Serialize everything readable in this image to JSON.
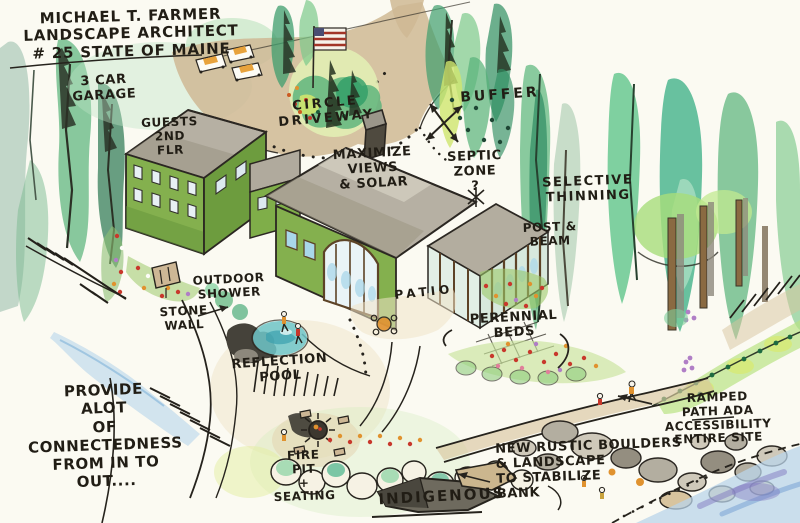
{
  "title_block": {
    "text": "MICHAEL T. FARMER\nLANDSCAPE ARCHITECT\n# 25 STATE OF MAINE"
  },
  "labels": {
    "garage": "3 CAR\nGARAGE",
    "guest_quarters": "GUESTS\n2ND\nFLR",
    "circle_driveway": "CIRCLE\nDRIVEWAY",
    "buffer": "BUFFER",
    "maximize_views_solar": "MAXIMIZE\nVIEWS\n& SOLAR",
    "septic_zone": "SEPTIC\nZONE\n?",
    "selective_thinning": "SELECTIVE\nTHINNING",
    "post_and_beam": "POST &\nBEAM",
    "outdoor_shower": "OUTDOOR\nSHOWER",
    "stone_wall": "STONE\nWALL",
    "patio": "PATIO",
    "perennial_beds": "PERENNIAL\nBEDS",
    "reflection_pool": "REFLECTION\nPOOL",
    "connectedness_note": "PROVIDE\nALOT\nOF\nCONNECTEDNESS\nFROM IN TO\nOUT....",
    "ramped_path_ada": "RAMPED\nPATH ADA\nACCESSIBILITY\nENTIRE SITE",
    "rustic_boulders": "NEW RUSTIC BOULDERS\n& LANDSCAPE\nTO STABILIZE\nBANK",
    "fire_pit_seating": "FIRE\nPIT\n+\nSEATING",
    "indigenous": "INDIGENOUS"
  },
  "palette": {
    "paper": "#fbfaf2",
    "ink": "#26231d",
    "tree_green": "#57b279",
    "tree_teal": "#2aa87c",
    "canopy_light": "#a8dd7a",
    "moss_yellow": "#cfe66e",
    "road_tan": "#cfb894",
    "roof_gray": "#b6b0a3",
    "wall_green": "#84b04e",
    "window_blue": "#a9d7ea",
    "timber_brown": "#5d4327",
    "water_blue": "#b9d4ea",
    "water_purple": "#8078bf",
    "flower_red": "#c8382c",
    "flower_orange": "#e0922f",
    "flower_purple": "#b07ec6",
    "boulder_gray": "#b3aea0",
    "stone_tan": "#d8c49e"
  }
}
